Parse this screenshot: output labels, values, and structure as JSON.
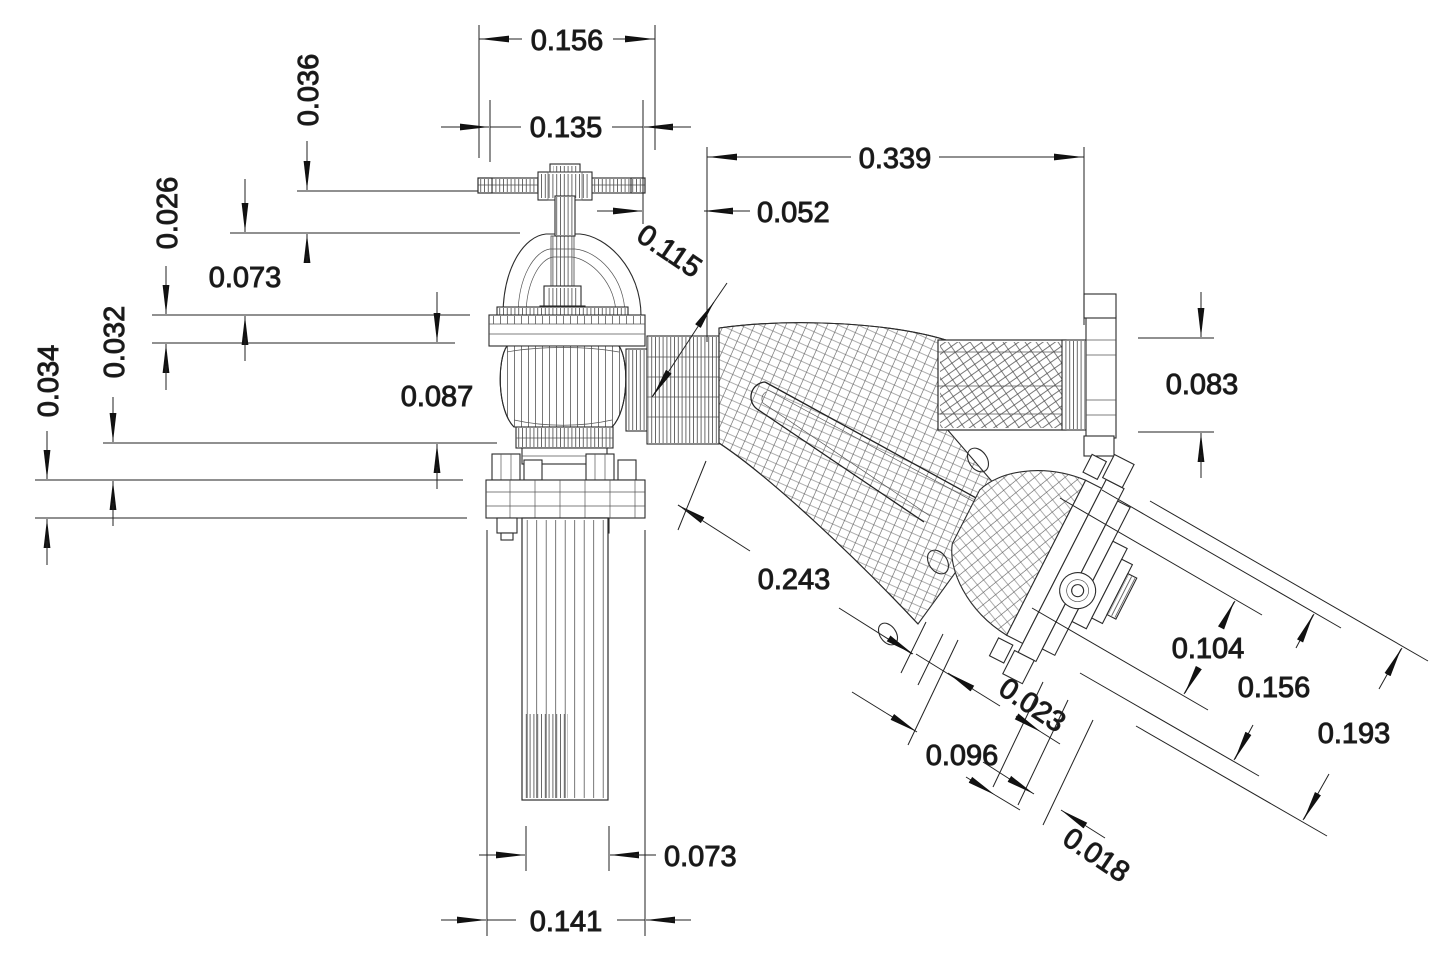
{
  "drawing": {
    "type": "CAD wireframe dimension drawing",
    "background": "#ffffff",
    "line_color": "#222222",
    "dims": {
      "top_width": "0.156",
      "handle_width": "0.135",
      "handle_height": "0.036",
      "inlet_length": "0.339",
      "stem_offset": "0.052",
      "outlet_bore": "0.115",
      "bonnet_height": "0.073",
      "flange_ring": "0.026",
      "collar": "0.032",
      "plate": "0.034",
      "barrel": "0.087",
      "inlet_od": "0.083",
      "cone_length": "0.243",
      "bell_id": "0.104",
      "bell_md": "0.156",
      "bell_od": "0.193",
      "tip_step": "0.023",
      "tip_len": "0.096",
      "tip_relief": "0.018",
      "pipe_od": "0.073",
      "plate_width": "0.141"
    }
  }
}
